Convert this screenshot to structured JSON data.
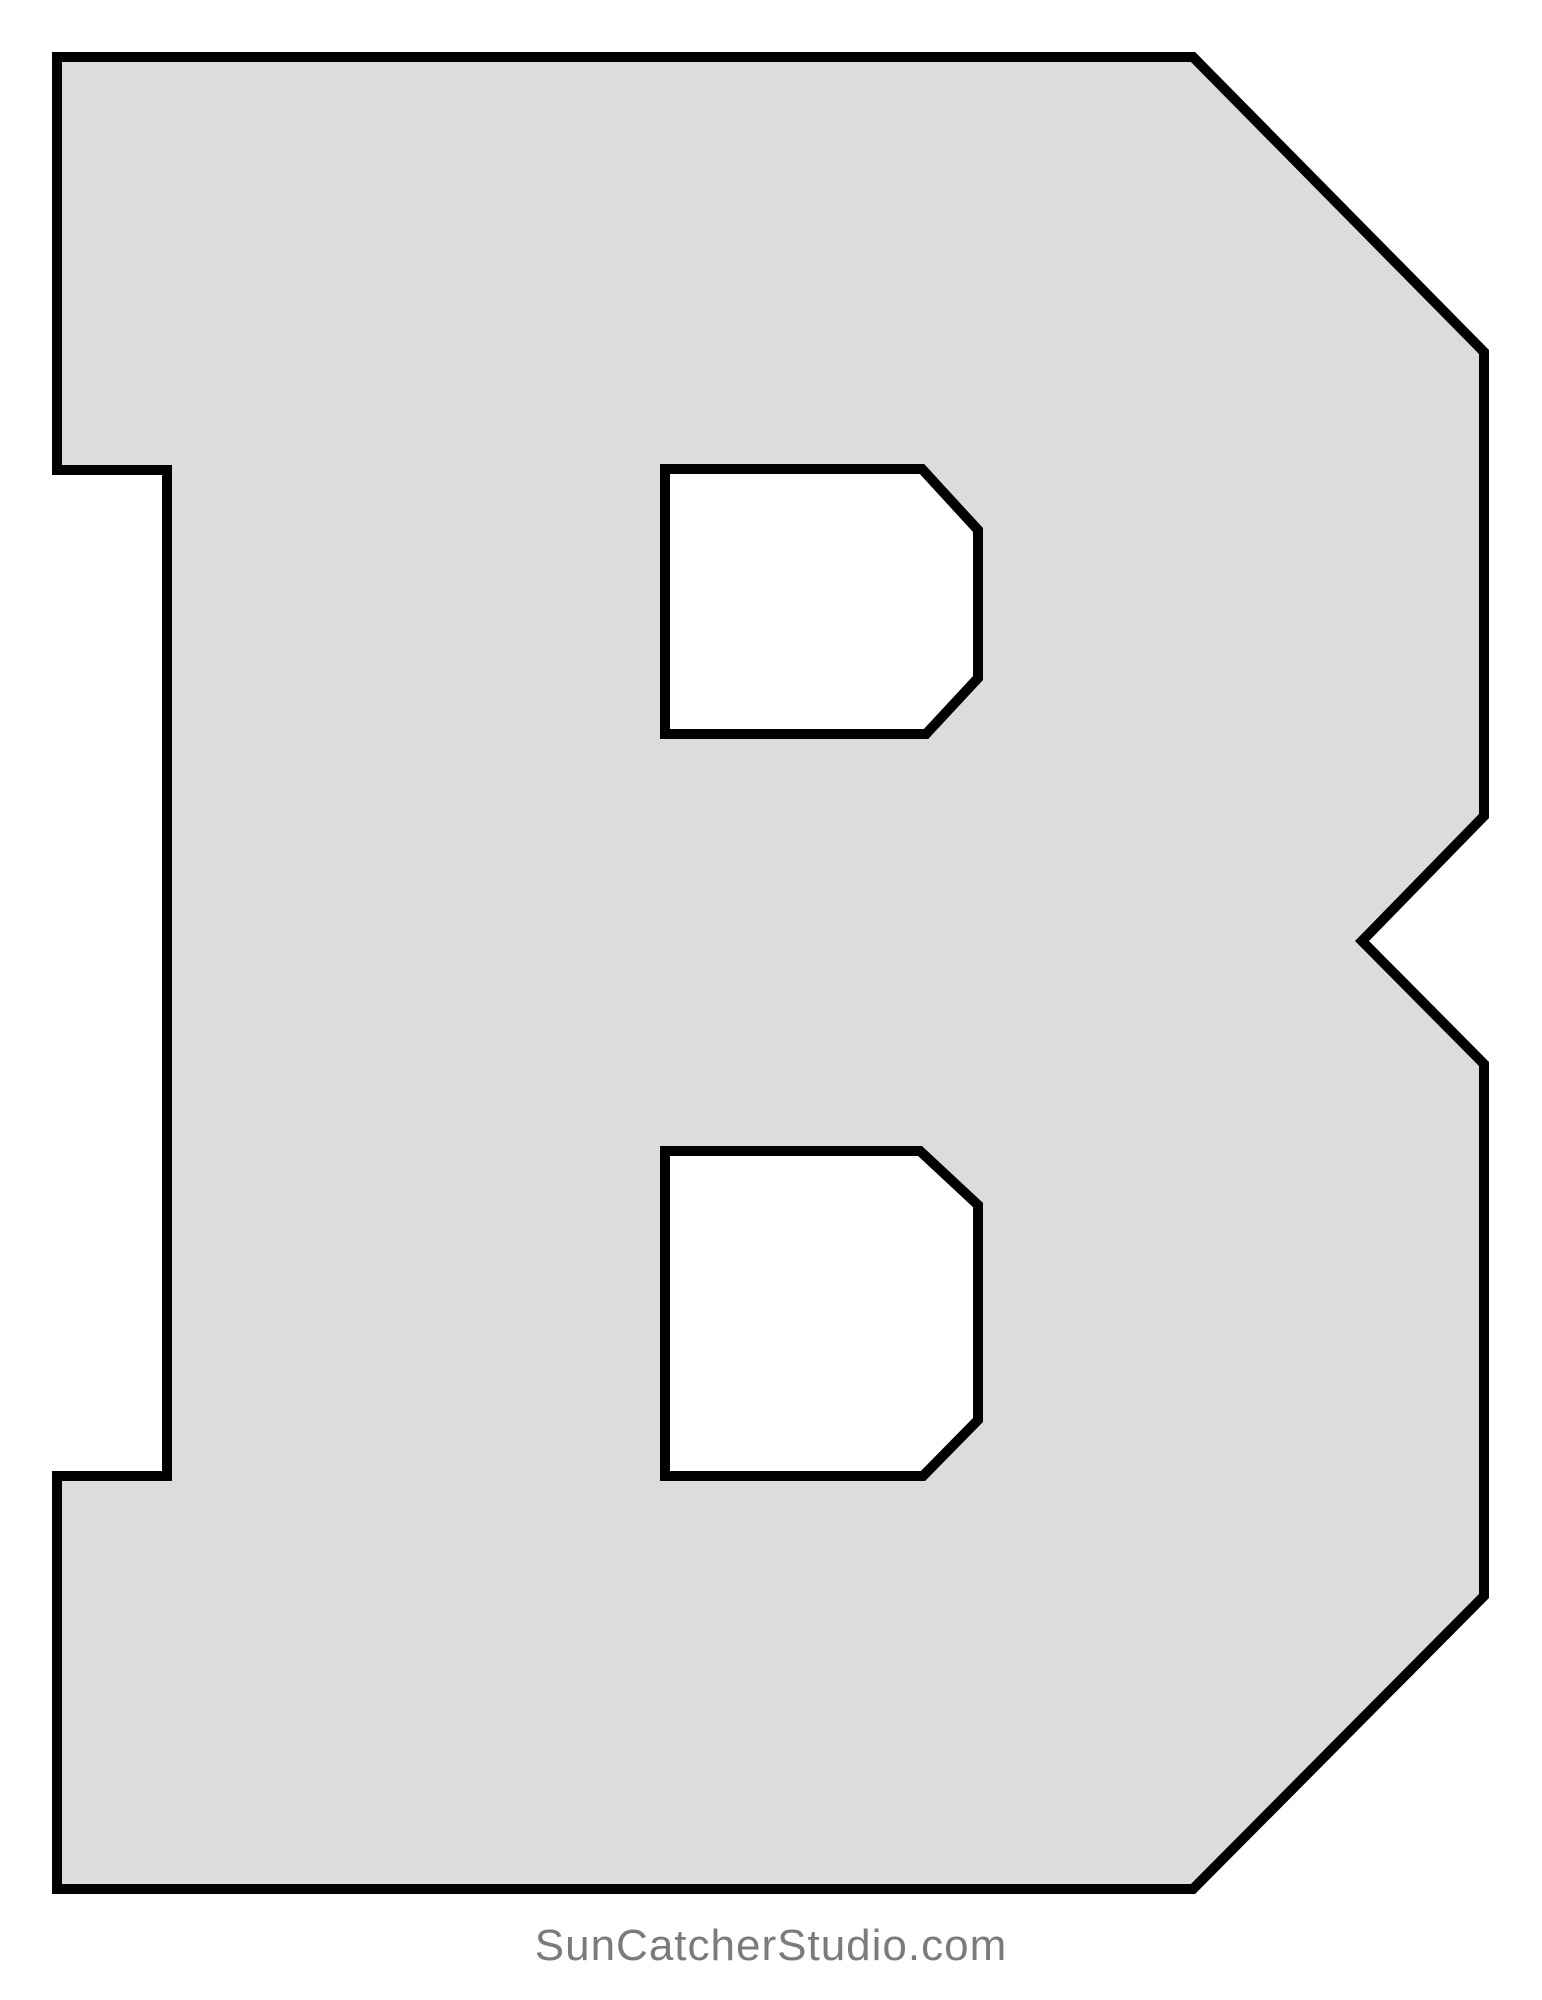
{
  "page": {
    "background_color": "#ffffff"
  },
  "pattern": {
    "letter": "B",
    "description": "block letter B stencil pattern",
    "fill_color": "#dcdcdc",
    "outline_color": "#000000",
    "outline_width": 10,
    "outline": [
      [
        57,
        57
      ],
      [
        1193,
        57
      ],
      [
        1484,
        352
      ],
      [
        1484,
        816
      ],
      [
        1362,
        941
      ],
      [
        1484,
        1064
      ],
      [
        1484,
        1596
      ],
      [
        1193,
        1889
      ],
      [
        57,
        1889
      ],
      [
        57,
        1476
      ],
      [
        167,
        1476
      ],
      [
        167,
        470
      ],
      [
        57,
        470
      ]
    ],
    "holes": [
      [
        [
          665,
          469
        ],
        [
          922,
          469
        ],
        [
          978,
          530
        ],
        [
          978,
          678
        ],
        [
          926,
          734
        ],
        [
          665,
          734
        ]
      ],
      [
        [
          665,
          1151
        ],
        [
          920,
          1151
        ],
        [
          978,
          1205
        ],
        [
          978,
          1420
        ],
        [
          923,
          1476
        ],
        [
          665,
          1476
        ]
      ]
    ]
  },
  "footer": {
    "text": "SunCatcherStudio.com",
    "color": "#7b7b7b"
  }
}
